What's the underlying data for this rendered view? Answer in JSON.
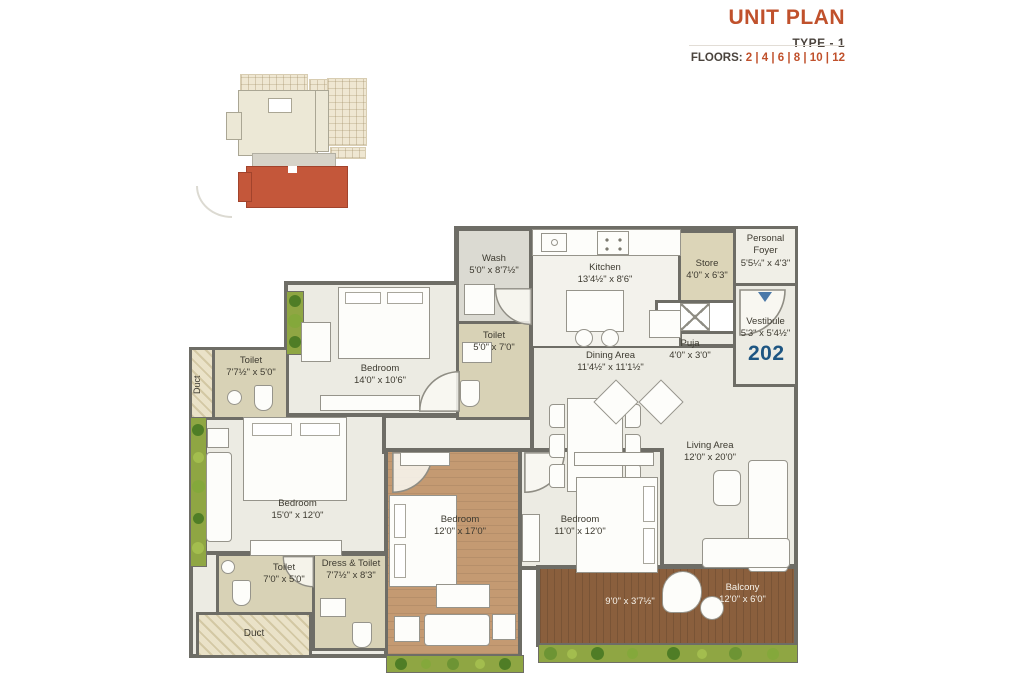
{
  "header": {
    "title": "UNIT PLAN",
    "subtitle": "TYPE - 1",
    "floors_label": "FLOORS:",
    "floors_values": "2 | 4 | 6 | 8 | 10 | 12"
  },
  "unit": {
    "number": "202"
  },
  "colors": {
    "accent": "#c0512c",
    "unit_number": "#1d5582",
    "wall": "#6e6d66",
    "site_highlight": "#c4573a",
    "balcony_deck": "#8a5f3d",
    "bedroom_wood": "#c49a72",
    "planter_green": "#8fa643"
  },
  "rooms": {
    "wash": {
      "name": "Wash",
      "dims": "5'0\" x 8'7½\""
    },
    "kitchen": {
      "name": "Kitchen",
      "dims": "13'4½\" x 8'6\""
    },
    "store": {
      "name": "Store",
      "dims": "4'0\" x 6'3\""
    },
    "foyer": {
      "name": "Personal Foyer",
      "dims": "5'5¼\" x 4'3\""
    },
    "vestibule": {
      "name": "Vestibule",
      "dims": "5'3\" x 5'4½\""
    },
    "puja": {
      "name": "Puja",
      "dims": "4'0\" x 3'0\""
    },
    "dining": {
      "name": "Dining Area",
      "dims": "11'4½\" x 11'1½\""
    },
    "living": {
      "name": "Living Area",
      "dims": "12'0\" x 20'0\""
    },
    "bedroom1": {
      "name": "Bedroom",
      "dims": "14'0\" x 10'6\""
    },
    "toilet1": {
      "name": "Toilet",
      "dims": "7'7½\" x 5'0\""
    },
    "toilet2": {
      "name": "Toilet",
      "dims": "5'0\" x 7'0\""
    },
    "bedroom2": {
      "name": "Bedroom",
      "dims": "15'0\" x 12'0\""
    },
    "bedroom3": {
      "name": "Bedroom",
      "dims": "12'0\" x 17'0\""
    },
    "bedroom4": {
      "name": "Bedroom",
      "dims": "11'0\" x 12'0\""
    },
    "toilet3": {
      "name": "Toilet",
      "dims": "7'0\" x 5'0\""
    },
    "dress_toilet": {
      "name": "Dress & Toilet",
      "dims": "7'7½\" x 8'3\""
    },
    "balcony": {
      "name": "Balcony",
      "dims": "12'0\" x 6'0\""
    },
    "balcony_left": {
      "dims": "9'0\" x 3'7½\""
    },
    "duct_left": {
      "name": "Duct"
    },
    "duct_bottom": {
      "name": "Duct"
    }
  }
}
